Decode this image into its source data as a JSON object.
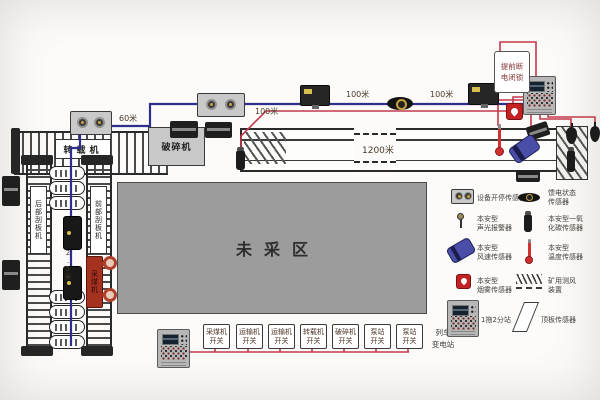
{
  "scene": {
    "machines": {
      "transfer": "转载机",
      "crusher": "破碎机",
      "unmined": "未采区",
      "shearer": "采煤机",
      "front_afc": "前部刮板机",
      "rear_afc": "后部刮板机"
    },
    "distances": {
      "d60": "60米",
      "d100_1": "100米",
      "d100_2": "100米",
      "d100_3": "100米",
      "d1200": "1200米",
      "d2_5": "2.5米"
    },
    "note": {
      "line1": "提前断",
      "line2": "电闭锁"
    },
    "train": {
      "line1": "列车",
      "line2": "变电站"
    },
    "switches": [
      {
        "line1": "采煤机",
        "line2": "开关"
      },
      {
        "line1": "运输机",
        "line2": "开关"
      },
      {
        "line1": "运输机",
        "line2": "开关"
      },
      {
        "line1": "转载机",
        "line2": "开关"
      },
      {
        "line1": "破碎机",
        "line2": "开关"
      },
      {
        "line1": "泵站",
        "line2": "开关"
      },
      {
        "line1": "泵站",
        "line2": "开关"
      }
    ],
    "legend": {
      "r1l": {
        "label1": "设备开停传感器",
        "label2": ""
      },
      "r1r": {
        "label1": "馈电状态",
        "label2": "传感器"
      },
      "r2l": {
        "label1": "本安型",
        "label2": "声光报警器"
      },
      "r2r": {
        "label1": "本安型一氧",
        "label2": "化碳传感器"
      },
      "r3l": {
        "label1": "本安型",
        "label2": "风速传感器"
      },
      "r3r": {
        "label1": "本安型",
        "label2": "温度传感器"
      },
      "r4l": {
        "label1": "本安型",
        "label2": "烟雾传感器"
      },
      "r4r": {
        "label1": "矿用测风",
        "label2": "装置"
      },
      "r5l": {
        "label1": "1拖2分站",
        "label2": ""
      },
      "r5r": {
        "label1": "顶板传感器",
        "label2": ""
      }
    },
    "colors": {
      "bus": "#2e2e8f",
      "control": "#c4394b",
      "unmined_fill": "#9c9c9c",
      "alarm": "#c32222"
    }
  }
}
